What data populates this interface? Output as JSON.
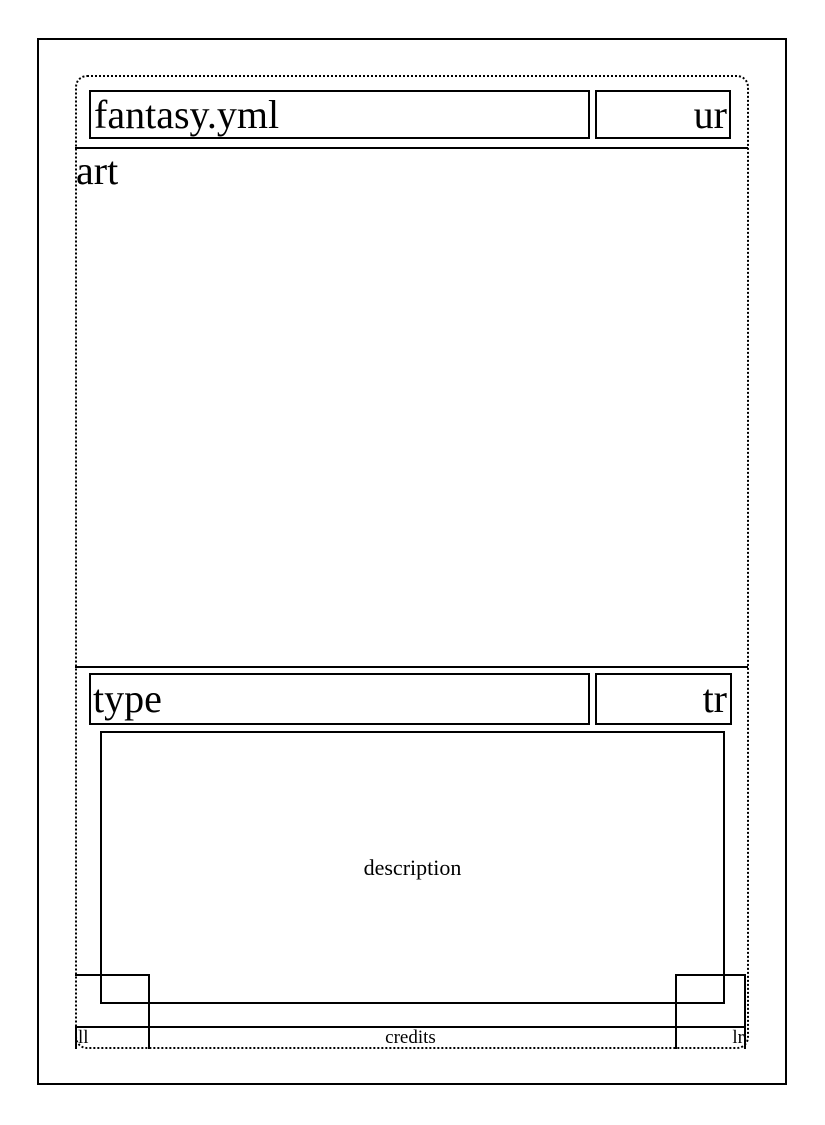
{
  "labels": {
    "title": "fantasy.yml",
    "upper_right": "ur",
    "art": "art",
    "type": "type",
    "type_right": "tr",
    "description": "description",
    "lower_left": "ll",
    "credits": "credits",
    "lower_right": "lr"
  },
  "colors": {
    "ink": "#000000",
    "paper": "#ffffff"
  }
}
